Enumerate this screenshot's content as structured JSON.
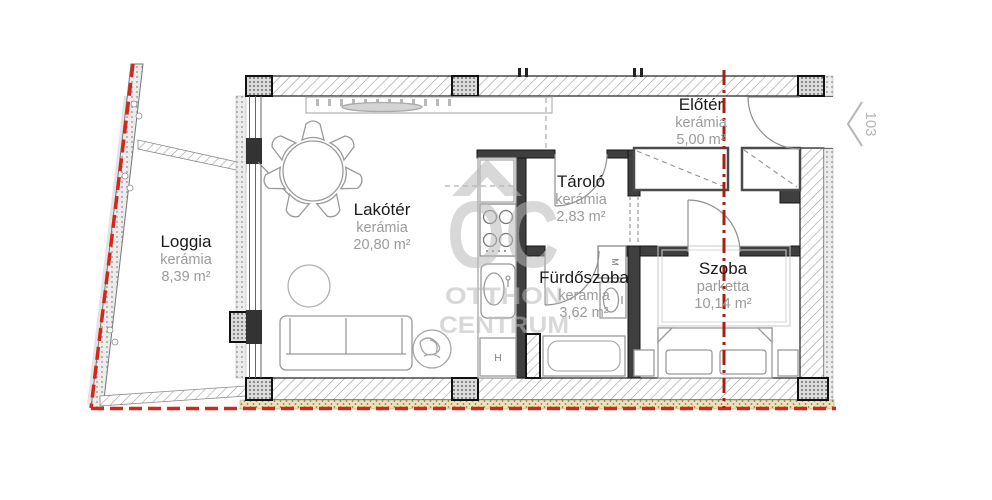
{
  "watermark": {
    "monogram": "OC",
    "line1": "OTTHON",
    "line2": "CENTRUM",
    "reg": "®"
  },
  "unit": {
    "number": "103"
  },
  "appliances": {
    "washer": "M",
    "fridge": "H"
  },
  "rooms": [
    {
      "id": "loggia",
      "name": "Loggia",
      "floor": "kerámia",
      "area": "8,39 m²"
    },
    {
      "id": "lakoter",
      "name": "Lakótér",
      "floor": "kerámia",
      "area": "20,80 m²"
    },
    {
      "id": "tarolo",
      "name": "Tároló",
      "floor": "kerámia",
      "area": "2,83 m²"
    },
    {
      "id": "eloter",
      "name": "Előtér",
      "floor": "kerámia",
      "area": "5,00 m²"
    },
    {
      "id": "furdoszoba",
      "name": "Fürdőszoba",
      "floor": "kerámia",
      "area": "3,62 m²"
    },
    {
      "id": "szoba",
      "name": "Szoba",
      "floor": "parketta",
      "area": "10,14 m²"
    }
  ],
  "colors": {
    "boundary_red": "#d2281c",
    "section_red": "#a61f12",
    "wall_dark": "#3f3f3f",
    "furniture_gray": "#9a9a9a",
    "watermark_gray": "#b9b9b9",
    "insulation_beige": "#eee3b8"
  }
}
